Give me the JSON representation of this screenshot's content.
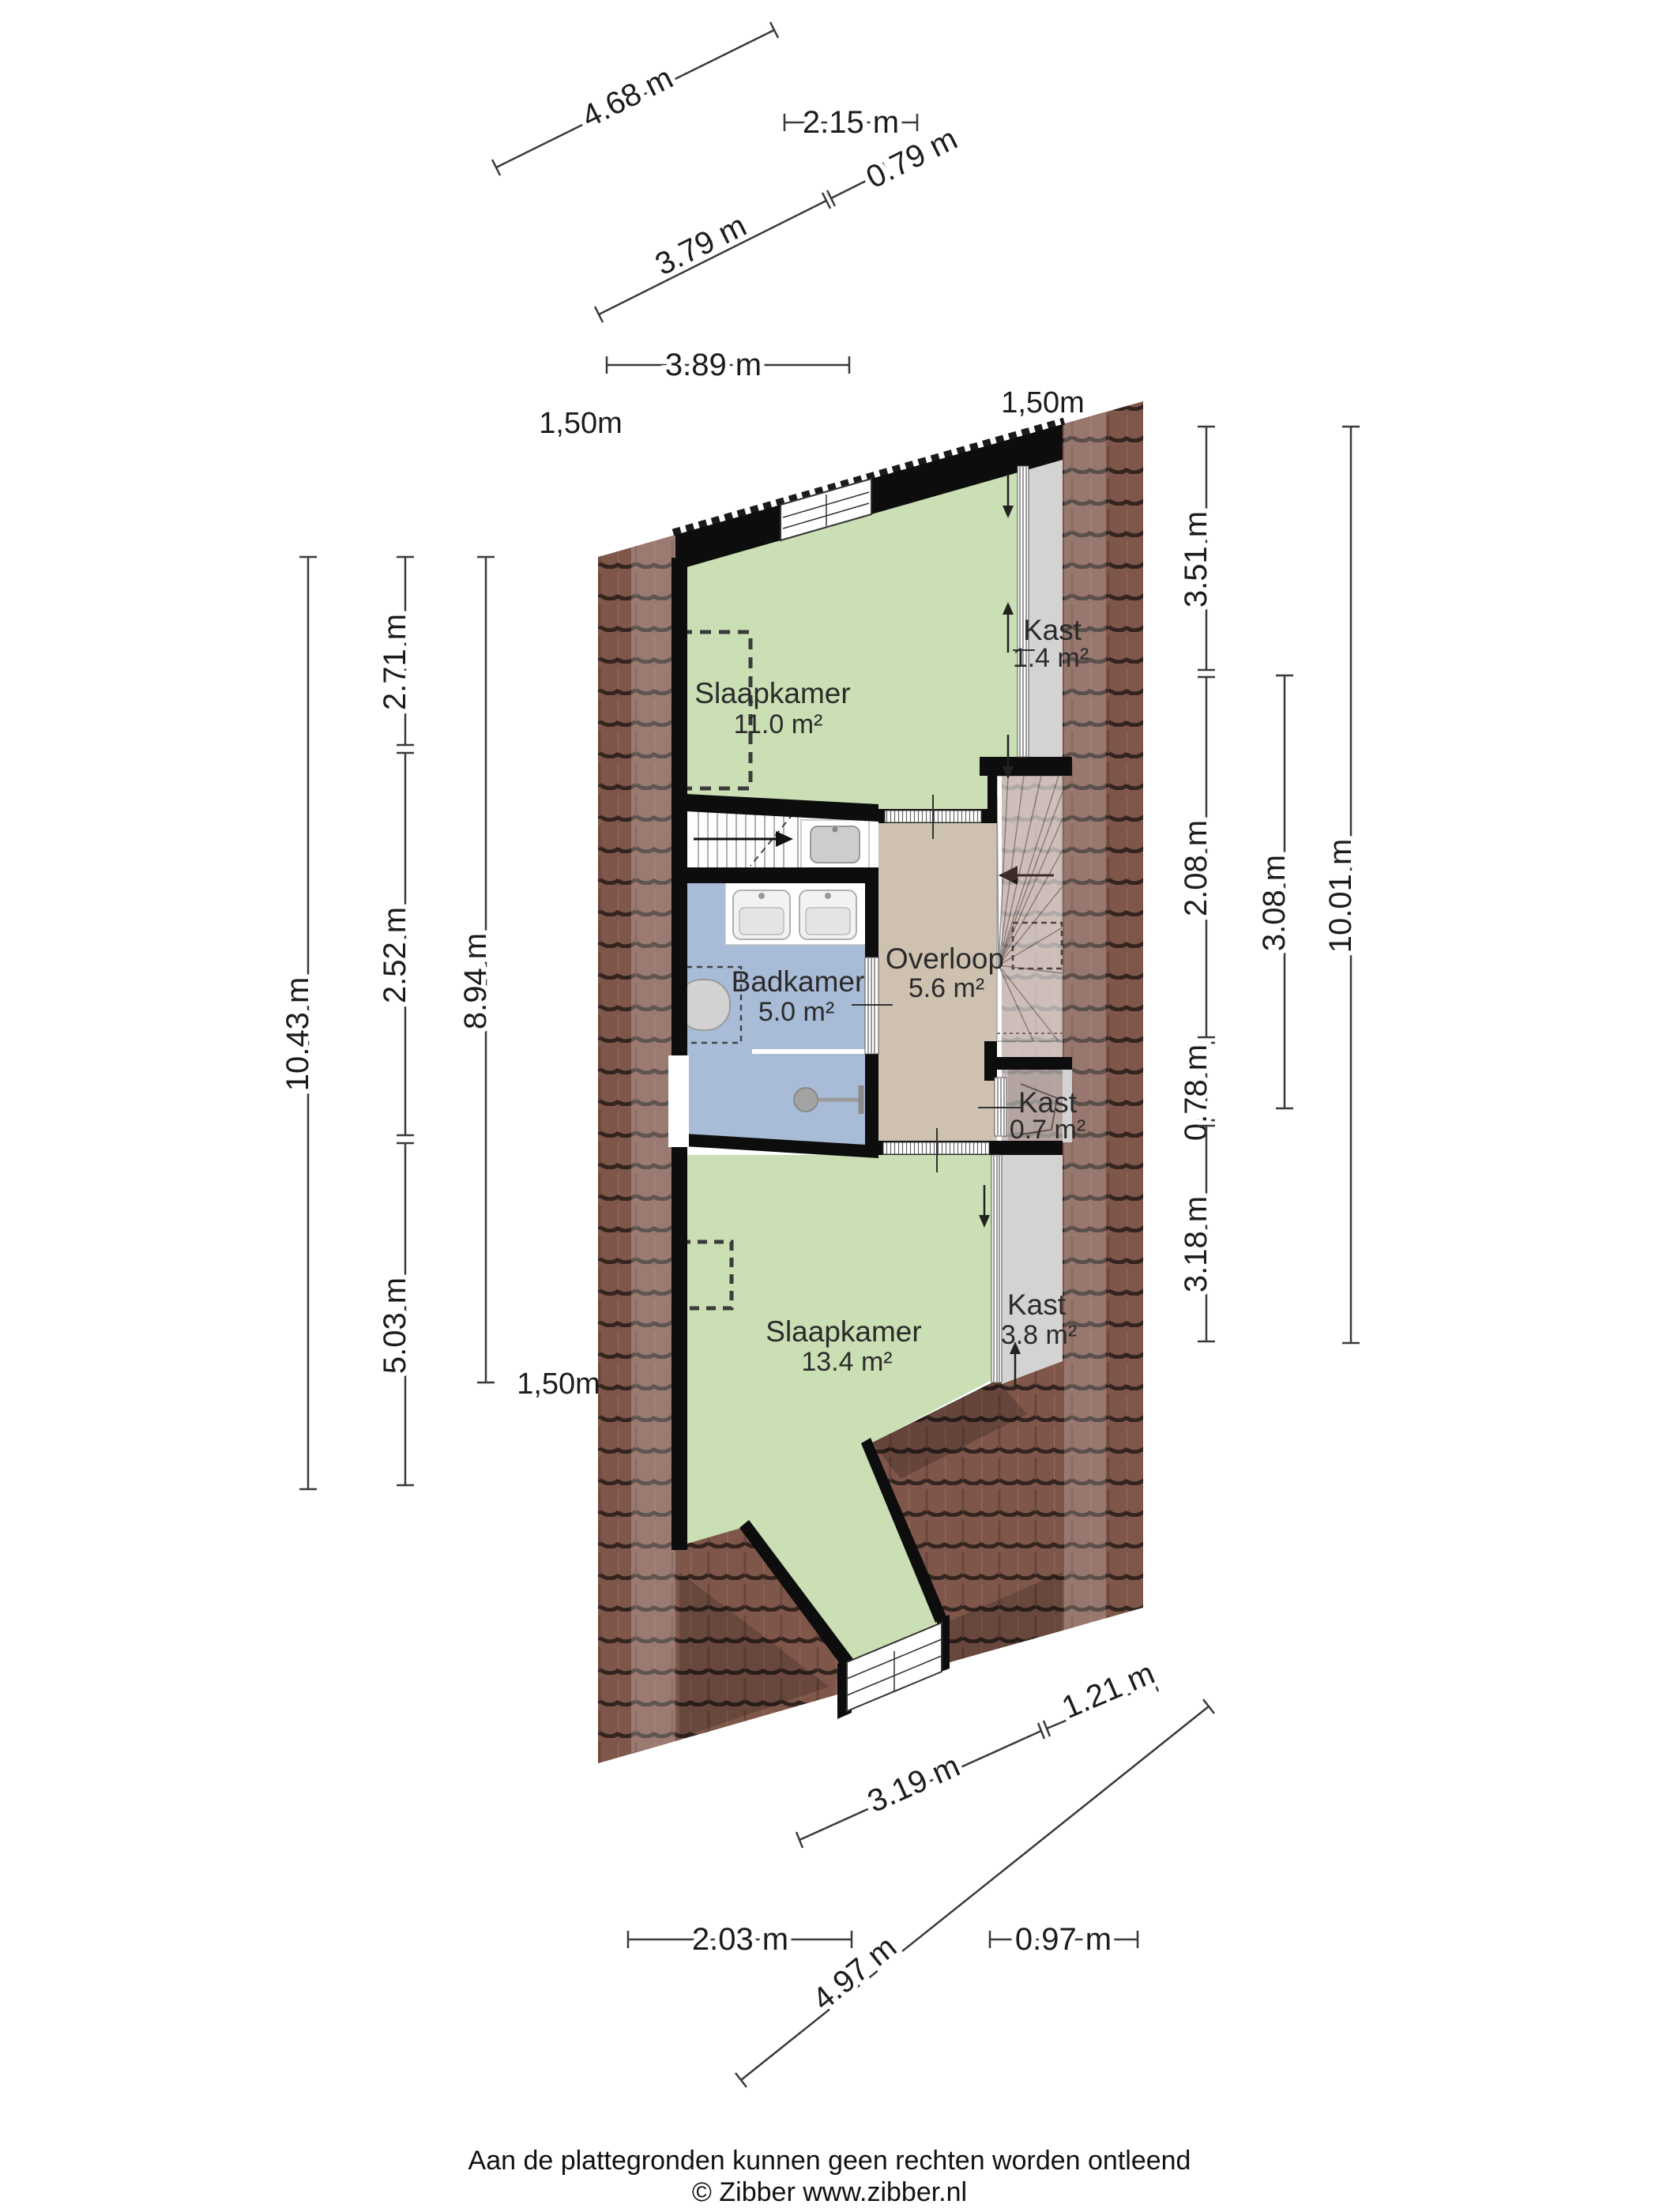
{
  "rooms": [
    {
      "label": "Slaapkamer",
      "area": "11.0 m²"
    },
    {
      "label": "Kast",
      "area": "1.4 m²"
    },
    {
      "label": "Badkamer",
      "area": "5.0 m²"
    },
    {
      "label": "Overloop",
      "area": "5.6 m²"
    },
    {
      "label": "Kast",
      "area": "0.7 m²"
    },
    {
      "label": "Slaapkamer",
      "area": "13.4 m²"
    },
    {
      "label": "Kast",
      "area": "3.8 m²"
    }
  ],
  "dimensions": {
    "top": [
      "4.68 m",
      "2.15 m",
      "0.79 m",
      "3.79 m",
      "3.89 m"
    ],
    "left": [
      "10.43 m",
      "2.71 m",
      "2.52 m",
      "5.03 m",
      "8.94 m"
    ],
    "right": [
      "3.51 m",
      "2.08 m",
      "0.78 m",
      "3.18 m",
      "3.08 m",
      "10.01 m"
    ],
    "bottom": [
      "1.21 m",
      "3.19 m",
      "2.03 m",
      "0.97 m",
      "4.97 m"
    ],
    "headroom": [
      "1,50m",
      "1,50m",
      "1,50m"
    ]
  },
  "footer": {
    "line1": "Aan de plattegronden kunnen geen rechten worden ontleend",
    "line2": "© Zibber www.zibber.nl"
  },
  "colors": {
    "bedroom_green": "#cadfb3",
    "bathroom_blue": "#a8bcd7",
    "hall_tan": "#cec1b0",
    "closet_gray": "#d3d3d3",
    "stairs_white": "#fdfdfd",
    "roof_brown": "#7f574a",
    "roof_line": "#33241f",
    "wall_black": "#0d0d0d"
  }
}
